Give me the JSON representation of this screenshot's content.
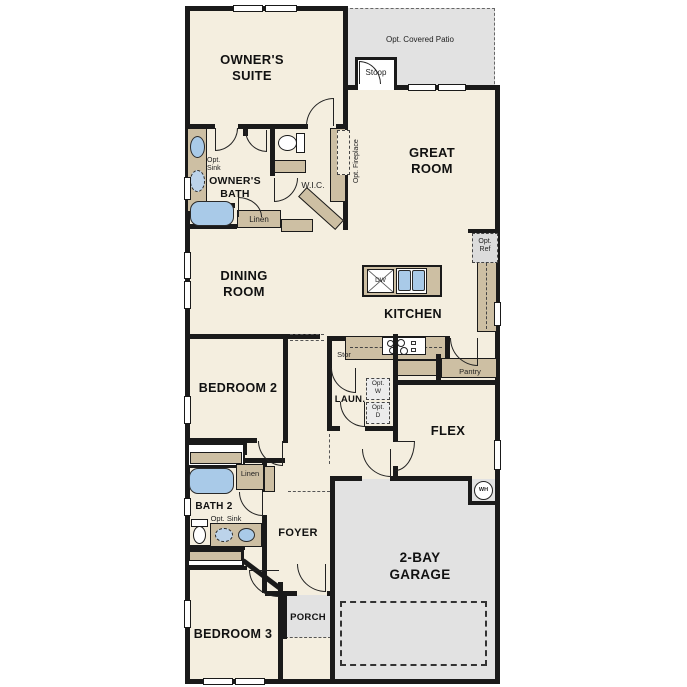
{
  "labels": {
    "owners_suite": "OWNER'S\nSUITE",
    "opt_covered_patio": "Opt. Covered Patio",
    "stoop": "Stoop",
    "great_room": "GREAT\nROOM",
    "owners_bath": "OWNER'S\nBATH",
    "opt_sink_owners": "Opt.\nSink",
    "wic": "W.I.C.",
    "opt_fireplace": "Opt. Fireplace",
    "linen_owners": "Linen",
    "dining_room": "DINING\nROOM",
    "kitchen": "KITCHEN",
    "dishwasher": "DW",
    "opt_ref": "Opt.\nRef",
    "stor": "Stor",
    "laundry": "LAUN.",
    "opt_washer": "Opt.\nW",
    "opt_dryer": "Opt.\nD",
    "pantry": "Pantry",
    "flex": "FLEX",
    "bedroom2": "BEDROOM 2",
    "linen_bath2": "Linen",
    "bath2": "BATH 2",
    "opt_sink_bath2": "Opt. Sink",
    "foyer": "FOYER",
    "bedroom3": "BEDROOM 3",
    "porch": "PORCH",
    "garage": "2-BAY\nGARAGE",
    "water_heater": "WH"
  },
  "colors": {
    "floor": "#f4eedf",
    "outdoor_gray": "#e2e2e2",
    "cabinet_tan": "#cdbfa3",
    "fixture_blue": "#a9cae8",
    "wall": "#1a1a1a"
  }
}
